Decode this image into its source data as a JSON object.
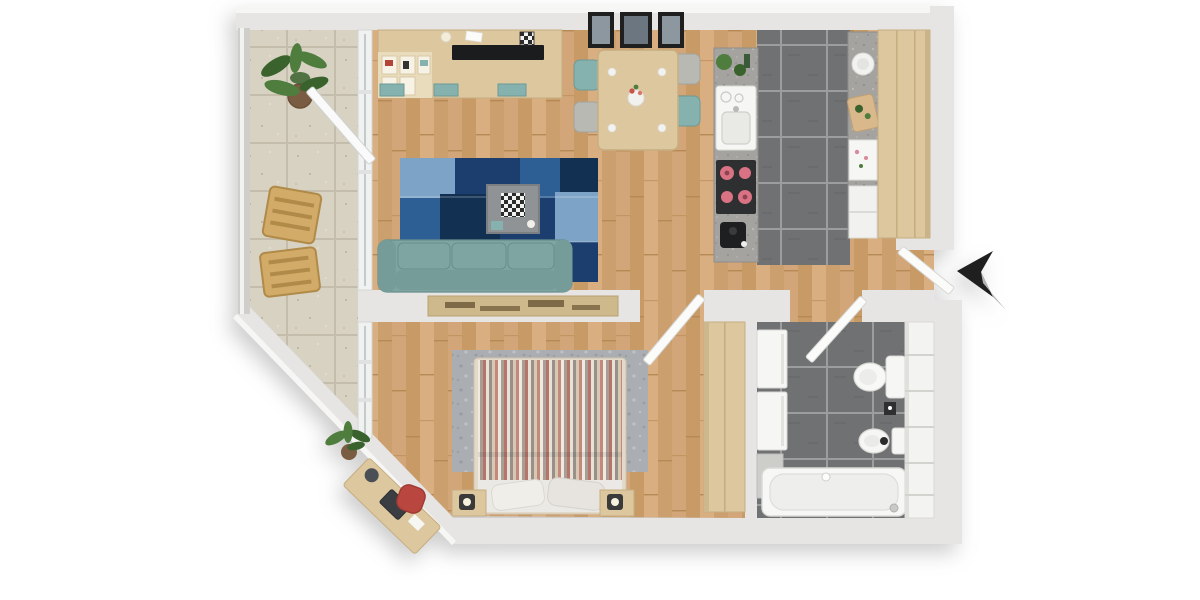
{
  "scene": {
    "type": "3d-floor-plan",
    "view": "top-down",
    "rooms": [
      {
        "name": "living-room",
        "floor": "wood-planks",
        "furniture": [
          "media-wall-unit",
          "tv",
          "shelf-cubbies",
          "teal-drawers",
          "blue-patchwork-rug",
          "coffee-table",
          "chessboard",
          "sofa"
        ]
      },
      {
        "name": "dining-area",
        "floor": "wood-planks",
        "furniture": [
          "dining-table",
          "flower-vase",
          "dining-chairs-x4",
          "wall-pictures-x3"
        ]
      },
      {
        "name": "kitchen",
        "floor": "dark-gray-tile",
        "furniture": [
          "granite-counter-left",
          "herb-plants",
          "sink",
          "dish-rack",
          "cooktop-4-burners",
          "coffee-machine",
          "granite-counter-right",
          "white-bowl",
          "cutting-board",
          "floral-cabinet",
          "tall-wood-cabinet"
        ]
      },
      {
        "name": "entrance-hall",
        "floor": "wood-planks",
        "furniture": [
          "entrance-door",
          "direction-arrow"
        ]
      },
      {
        "name": "bedroom",
        "floor": "wood-planks",
        "furniture": [
          "wall-art-panorama",
          "gray-rug",
          "double-bed-striped-duvet",
          "pillows-x2",
          "nightstand-left",
          "nightstand-right",
          "lamps-x2",
          "wardrobe",
          "desk",
          "laptop",
          "globe",
          "red-desk-chair",
          "plant",
          "balcony-windows"
        ]
      },
      {
        "name": "bathroom",
        "floor": "dark-gray-tile",
        "furniture": [
          "washer-stack",
          "low-cabinet",
          "toilet",
          "small-wall-art",
          "bidet",
          "bathtub",
          "shelving-unit"
        ]
      },
      {
        "name": "balcony",
        "floor": "beige-ceramic-tile",
        "furniture": [
          "potted-plant",
          "wood-chair-upper",
          "wood-chair-lower",
          "glass-railing",
          "sliding-glass-door"
        ]
      }
    ],
    "doors": [
      "entrance-door-open",
      "bedroom-door-open",
      "bathroom-door-open",
      "balcony-slider-open"
    ],
    "colors": {
      "wall": "#e6e5e3",
      "wallEdge": "#cfcecb",
      "wallLite": "#f6f6f4",
      "woodA": "#d2a678",
      "woodB": "#c79a66",
      "woodC": "#d9ae81",
      "woodD": "#cb9f6e",
      "woodLine": "#b78a55",
      "btBase": "#d8d2c3",
      "btLine": "#c4bdab",
      "btDot": "#b9b19d",
      "dtBase": "#6f7173",
      "dtGrout": "#9b9d9f",
      "dtDot": "#636568",
      "granite": "#a5a3a0",
      "graniteDot": "#8b8986",
      "graniteLite": "#bdbbb8",
      "furnWood": "#ddc79f",
      "furnWoodDark": "#c6ae80",
      "teal": "#85b2ae",
      "tealDark": "#6d9a96",
      "sofa": "#7fa5a2",
      "sofaDark": "#678f8c",
      "sofaBack": "#769c99",
      "rug1": "#1c3e6e",
      "rug2": "#2d5f94",
      "rug3": "#7da3c6",
      "rug4": "#123052",
      "rug5": "#4878a8",
      "tv": "#1b1c1e",
      "fixture": "#f6f6f4",
      "fixtureEdge": "#d8d8d5",
      "bedS1": "#b5756a",
      "bedS2": "#e9e1d5",
      "bedS3": "#97918a",
      "bedS4": "#d8c8b3",
      "bedS5": "#c28a7d",
      "bedS6": "#efe9e0",
      "bedS7": "#a79f96",
      "grayRug": "#aaaeb3",
      "grayRugDot": "#989ca1",
      "plant": "#4e7d3d",
      "plantDark": "#39622c",
      "pot": "#7a5c42",
      "arrow": "#1f1f1f",
      "arrowShadow": "#b3b3b3",
      "sepia": "#cdb98b",
      "sepiaMark": "#6b5636",
      "redChair": "#b9473f",
      "burner": "#d97283",
      "dark": "#2e2f31"
    }
  }
}
